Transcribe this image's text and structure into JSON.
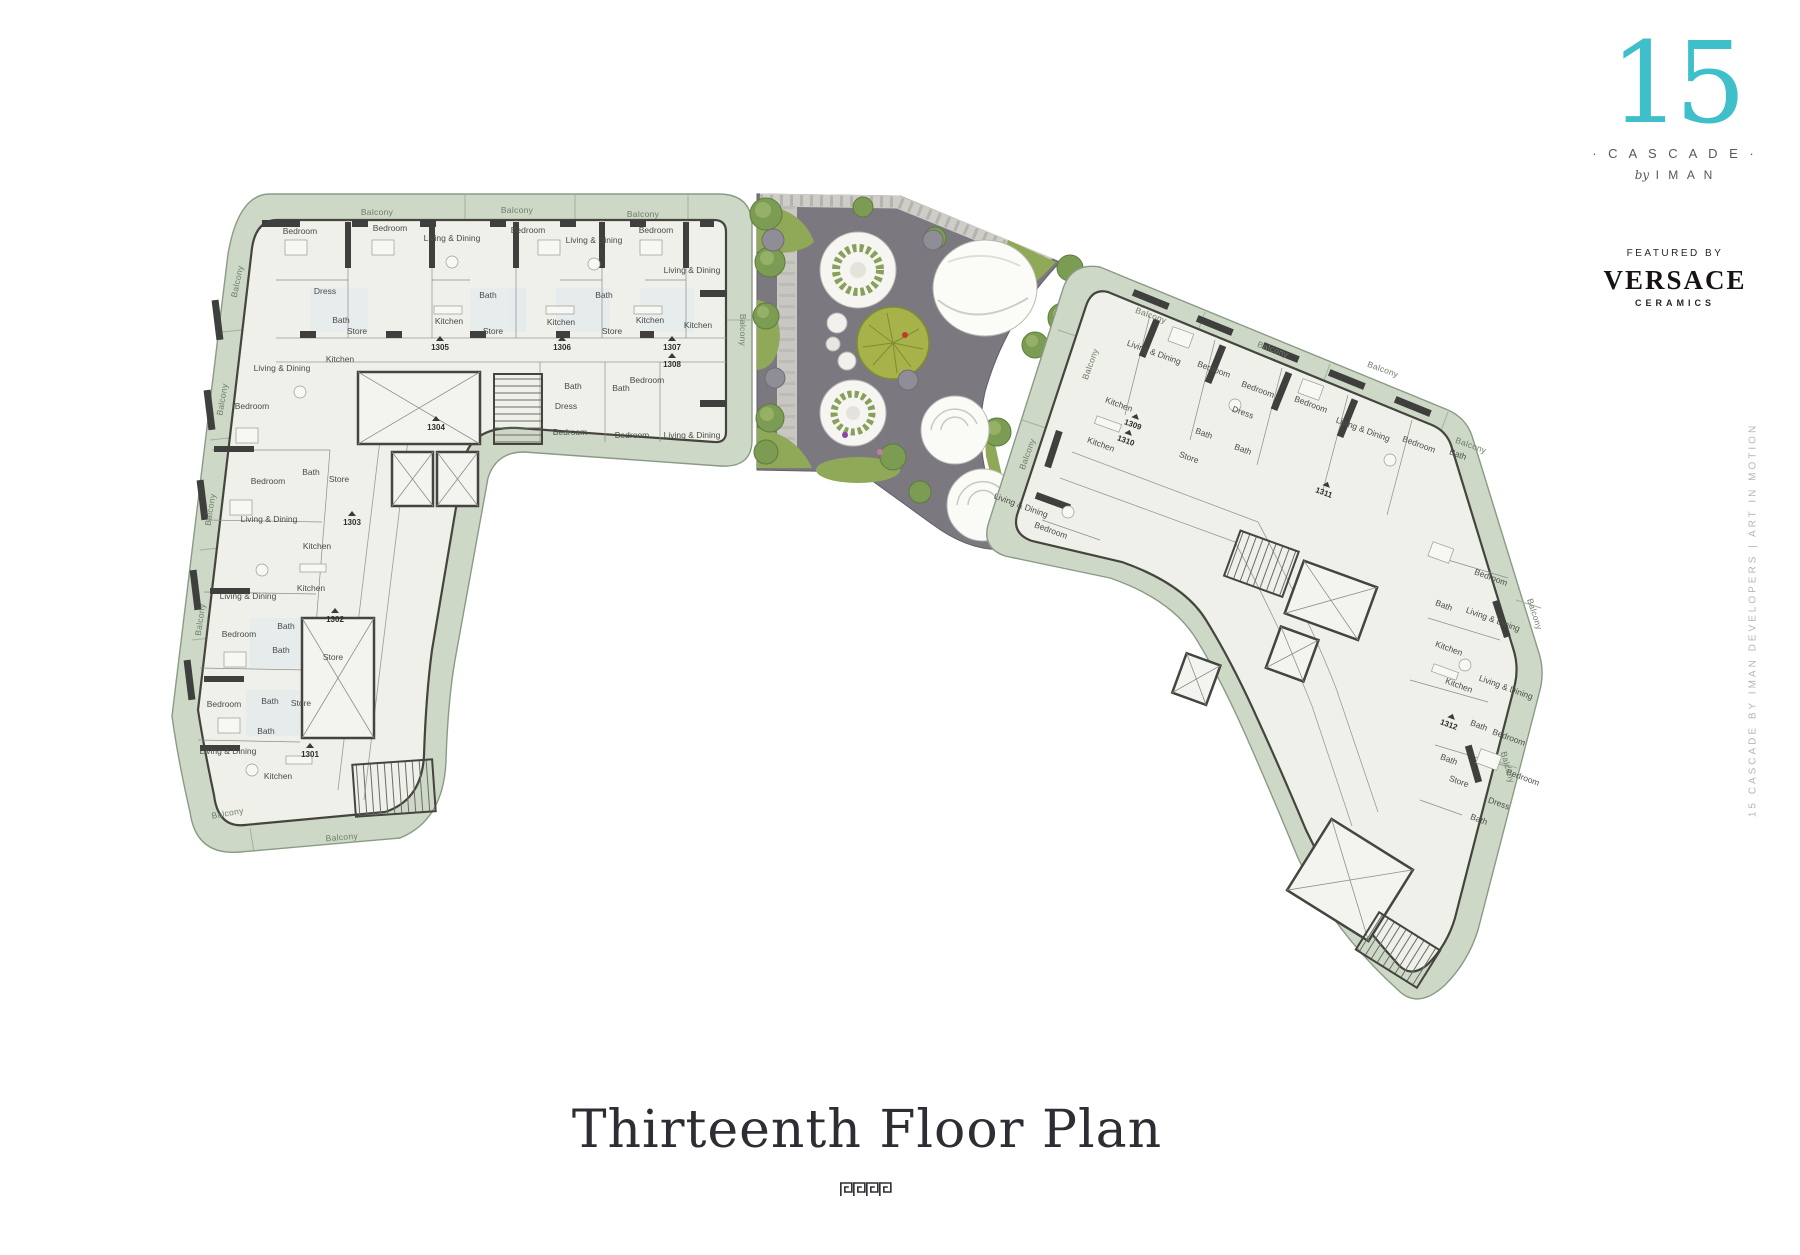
{
  "title": "Thirteenth Floor Plan",
  "brand": {
    "number": "15",
    "name": "· C A S C A D E ·",
    "by_prefix": "by",
    "by_name": "I M A N",
    "featured_by": "FEATURED BY",
    "featured_brand": "VERSACE",
    "featured_brand_sub": "CERAMICS"
  },
  "side_text": "15 CASCADE BY IMAN DEVELOPERS | ART IN MOTION",
  "colors": {
    "accent_teal": "#3fbfca",
    "balcony_band": "#cdd9c6",
    "floor": "#eef0e9",
    "wall": "#45443f",
    "garden_paving": "#7b7880",
    "lawn": "#8fa959",
    "tree": "#7d9c53",
    "walkway": "#cfcdc7",
    "title_text": "#2e2d33",
    "label_text": "#4b4b49",
    "muted_text": "#b5b5b5"
  },
  "plan": {
    "balcony_label": "Balcony",
    "left_wing_labels": [
      {
        "t": "Bedroom",
        "x": 300,
        "y": 234,
        "r": 0
      },
      {
        "t": "Bedroom",
        "x": 390,
        "y": 231,
        "r": 0
      },
      {
        "t": "Living & Dining",
        "x": 452,
        "y": 241,
        "r": 0
      },
      {
        "t": "Bedroom",
        "x": 528,
        "y": 233,
        "r": 0
      },
      {
        "t": "Living & Dining",
        "x": 594,
        "y": 243,
        "r": 0
      },
      {
        "t": "Bedroom",
        "x": 656,
        "y": 233,
        "r": 0
      },
      {
        "t": "Living & Dining",
        "x": 692,
        "y": 273,
        "r": 0
      },
      {
        "t": "Dress",
        "x": 325,
        "y": 294,
        "r": 0
      },
      {
        "t": "Bath",
        "x": 341,
        "y": 323,
        "r": 0
      },
      {
        "t": "Store",
        "x": 357,
        "y": 334,
        "r": 0
      },
      {
        "t": "Kitchen",
        "x": 449,
        "y": 324,
        "r": 0
      },
      {
        "t": "Bath",
        "x": 488,
        "y": 298,
        "r": 0
      },
      {
        "t": "Store",
        "x": 493,
        "y": 334,
        "r": 0
      },
      {
        "t": "Kitchen",
        "x": 561,
        "y": 325,
        "r": 0
      },
      {
        "t": "Bath",
        "x": 604,
        "y": 298,
        "r": 0
      },
      {
        "t": "Store",
        "x": 612,
        "y": 334,
        "r": 0
      },
      {
        "t": "Kitchen",
        "x": 650,
        "y": 323,
        "r": 0
      },
      {
        "t": "Kitchen",
        "x": 698,
        "y": 328,
        "r": 0
      },
      {
        "t": "Bath",
        "x": 573,
        "y": 389,
        "r": 0
      },
      {
        "t": "Bath",
        "x": 621,
        "y": 391,
        "r": 0
      },
      {
        "t": "Dress",
        "x": 566,
        "y": 409,
        "r": 0
      },
      {
        "t": "Bedroom",
        "x": 647,
        "y": 383,
        "r": 0
      },
      {
        "t": "Bedroom",
        "x": 570,
        "y": 435,
        "r": 0
      },
      {
        "t": "Bedroom",
        "x": 632,
        "y": 438,
        "r": 0
      },
      {
        "t": "Living & Dining",
        "x": 692,
        "y": 438,
        "r": 0
      },
      {
        "t": "Living & Dining",
        "x": 282,
        "y": 371,
        "r": 0
      },
      {
        "t": "Kitchen",
        "x": 340,
        "y": 362,
        "r": 0
      },
      {
        "t": "Bedroom",
        "x": 252,
        "y": 409,
        "r": 0
      },
      {
        "t": "Bedroom",
        "x": 268,
        "y": 484,
        "r": 0
      },
      {
        "t": "Bath",
        "x": 311,
        "y": 475,
        "r": 0
      },
      {
        "t": "Store",
        "x": 339,
        "y": 482,
        "r": 0
      },
      {
        "t": "Living & Dining",
        "x": 269,
        "y": 522,
        "r": 0
      },
      {
        "t": "Kitchen",
        "x": 317,
        "y": 549,
        "r": 0
      },
      {
        "t": "Kitchen",
        "x": 311,
        "y": 591,
        "r": 0
      },
      {
        "t": "Living & Dining",
        "x": 248,
        "y": 599,
        "r": 0
      },
      {
        "t": "Bath",
        "x": 286,
        "y": 629,
        "r": 0
      },
      {
        "t": "Bedroom",
        "x": 239,
        "y": 637,
        "r": 0
      },
      {
        "t": "Bath",
        "x": 281,
        "y": 653,
        "r": 0
      },
      {
        "t": "Store",
        "x": 333,
        "y": 660,
        "r": 0
      },
      {
        "t": "Bedroom",
        "x": 224,
        "y": 707,
        "r": 0
      },
      {
        "t": "Bath",
        "x": 270,
        "y": 704,
        "r": 0
      },
      {
        "t": "Store",
        "x": 301,
        "y": 706,
        "r": 0
      },
      {
        "t": "Bath",
        "x": 266,
        "y": 734,
        "r": 0
      },
      {
        "t": "Living & Dining",
        "x": 228,
        "y": 754,
        "r": 0
      },
      {
        "t": "Kitchen",
        "x": 278,
        "y": 779,
        "r": 0
      }
    ],
    "right_wing_labels": [
      {
        "t": "Living & Dining",
        "x": 1153,
        "y": 355,
        "r": 20
      },
      {
        "t": "Bedroom",
        "x": 1213,
        "y": 372,
        "r": 20
      },
      {
        "t": "Bedroom",
        "x": 1257,
        "y": 392,
        "r": 20
      },
      {
        "t": "Bedroom",
        "x": 1310,
        "y": 407,
        "r": 20
      },
      {
        "t": "Living & Dining",
        "x": 1362,
        "y": 432,
        "r": 20
      },
      {
        "t": "Bedroom",
        "x": 1418,
        "y": 447,
        "r": 20
      },
      {
        "t": "Bath",
        "x": 1457,
        "y": 457,
        "r": 20
      },
      {
        "t": "Kitchen",
        "x": 1118,
        "y": 407,
        "r": 20
      },
      {
        "t": "Kitchen",
        "x": 1100,
        "y": 447,
        "r": 20
      },
      {
        "t": "Dress",
        "x": 1242,
        "y": 415,
        "r": 20
      },
      {
        "t": "Bath",
        "x": 1203,
        "y": 436,
        "r": 20
      },
      {
        "t": "Bath",
        "x": 1242,
        "y": 452,
        "r": 20
      },
      {
        "t": "Store",
        "x": 1188,
        "y": 460,
        "r": 20
      },
      {
        "t": "Living & Dining",
        "x": 1020,
        "y": 508,
        "r": 20
      },
      {
        "t": "Bedroom",
        "x": 1050,
        "y": 533,
        "r": 20
      },
      {
        "t": "Bedroom",
        "x": 1490,
        "y": 580,
        "r": 20
      },
      {
        "t": "Living & Dining",
        "x": 1492,
        "y": 622,
        "r": 20
      },
      {
        "t": "Bath",
        "x": 1443,
        "y": 608,
        "r": 20
      },
      {
        "t": "Kitchen",
        "x": 1448,
        "y": 651,
        "r": 20
      },
      {
        "t": "Kitchen",
        "x": 1458,
        "y": 688,
        "r": 20
      },
      {
        "t": "Living & Dining",
        "x": 1505,
        "y": 690,
        "r": 20
      },
      {
        "t": "Bedroom",
        "x": 1508,
        "y": 740,
        "r": 20
      },
      {
        "t": "Bath",
        "x": 1478,
        "y": 728,
        "r": 20
      },
      {
        "t": "Bath",
        "x": 1448,
        "y": 762,
        "r": 20
      },
      {
        "t": "Store",
        "x": 1458,
        "y": 784,
        "r": 20
      },
      {
        "t": "Bedroom",
        "x": 1522,
        "y": 780,
        "r": 20
      },
      {
        "t": "Dress",
        "x": 1498,
        "y": 806,
        "r": 20
      },
      {
        "t": "Bath",
        "x": 1478,
        "y": 822,
        "r": 20
      }
    ],
    "balcony_labels": [
      {
        "x": 377,
        "y": 215,
        "r": 0
      },
      {
        "x": 517,
        "y": 213,
        "r": 0
      },
      {
        "x": 643,
        "y": 217,
        "r": 0
      },
      {
        "x": 740,
        "y": 330,
        "r": 90
      },
      {
        "x": 240,
        "y": 282,
        "r": -78
      },
      {
        "x": 225,
        "y": 400,
        "r": -80
      },
      {
        "x": 213,
        "y": 510,
        "r": -81
      },
      {
        "x": 203,
        "y": 620,
        "r": -82
      },
      {
        "x": 228,
        "y": 816,
        "r": -10
      },
      {
        "x": 342,
        "y": 840,
        "r": -5
      },
      {
        "x": 1150,
        "y": 318,
        "r": 20
      },
      {
        "x": 1272,
        "y": 352,
        "r": 20
      },
      {
        "x": 1382,
        "y": 372,
        "r": 20
      },
      {
        "x": 1470,
        "y": 448,
        "r": 20
      },
      {
        "x": 1532,
        "y": 615,
        "r": 72
      },
      {
        "x": 1505,
        "y": 768,
        "r": 75
      },
      {
        "x": 1093,
        "y": 365,
        "r": -70
      },
      {
        "x": 1030,
        "y": 455,
        "r": -70
      }
    ],
    "unit_numbers": [
      {
        "n": "1301",
        "x": 310,
        "y": 757,
        "r": 0
      },
      {
        "n": "1302",
        "x": 335,
        "y": 622,
        "r": 0
      },
      {
        "n": "1303",
        "x": 352,
        "y": 525,
        "r": 0
      },
      {
        "n": "1304",
        "x": 436,
        "y": 430,
        "r": 0
      },
      {
        "n": "1305",
        "x": 440,
        "y": 350,
        "r": 0
      },
      {
        "n": "1306",
        "x": 562,
        "y": 350,
        "r": 0
      },
      {
        "n": "1307",
        "x": 672,
        "y": 350,
        "r": 0
      },
      {
        "n": "1308",
        "x": 672,
        "y": 367,
        "r": 0
      },
      {
        "n": "1309",
        "x": 1132,
        "y": 427,
        "r": 20
      },
      {
        "n": "1310",
        "x": 1125,
        "y": 443,
        "r": 20
      },
      {
        "n": "1311",
        "x": 1323,
        "y": 495,
        "r": 20
      },
      {
        "n": "1312",
        "x": 1448,
        "y": 727,
        "r": 20
      }
    ]
  }
}
